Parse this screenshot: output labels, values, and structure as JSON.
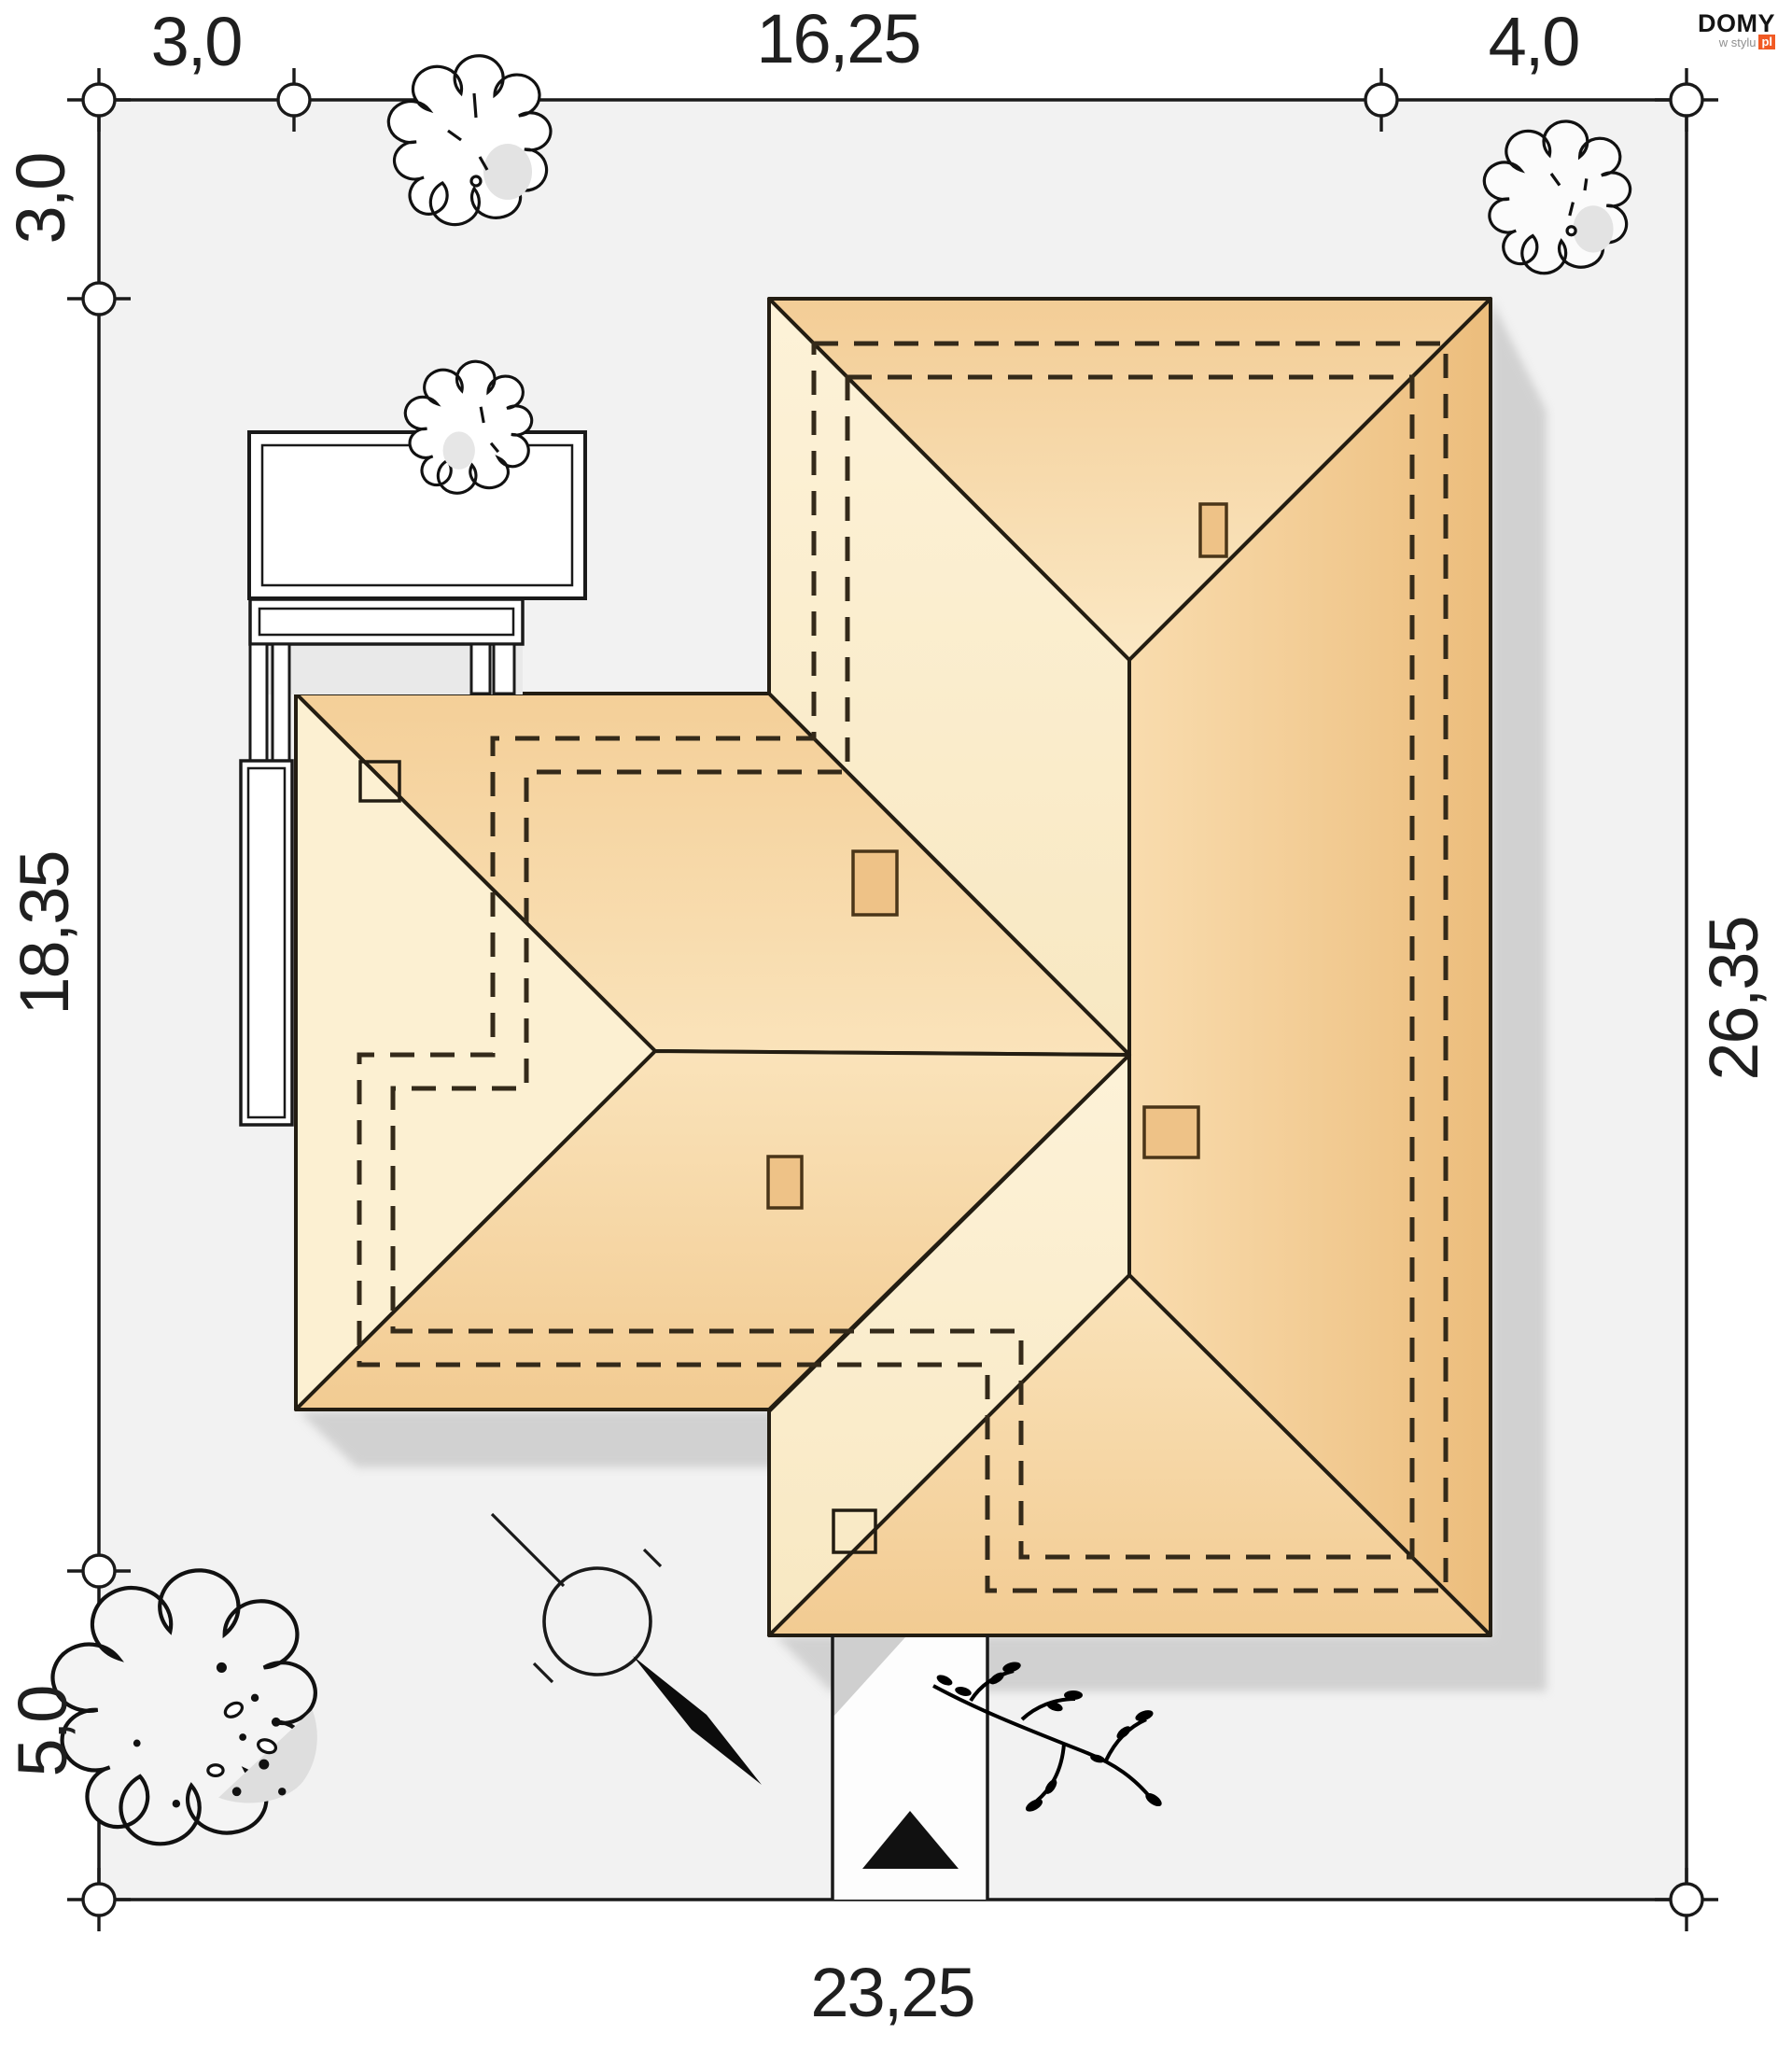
{
  "logo": {
    "brand": "DOMY",
    "tagline": "w stylu",
    "domain_suffix": "pl",
    "accent_color": "#f15a24"
  },
  "dimensions": {
    "top": [
      {
        "label": "3,0"
      },
      {
        "label": "16,25"
      },
      {
        "label": "4,0"
      }
    ],
    "left": [
      {
        "label": "3,0"
      },
      {
        "label": "18,35"
      },
      {
        "label": "5,0"
      }
    ],
    "right": [
      {
        "label": "26,35"
      }
    ],
    "bottom": [
      {
        "label": "23,25"
      }
    ]
  },
  "colors": {
    "plot_fill": "#f2f2f2",
    "outline": "#231d12",
    "roof_cream": "#fcf0d2",
    "roof_peach": "#f6d5a2",
    "roof_orange": "#eec07e",
    "chimney_fill": "#eec287",
    "shadow": "#c9c9c9",
    "dash_color": "#342a1a",
    "label_color": "#1f1f1f"
  }
}
